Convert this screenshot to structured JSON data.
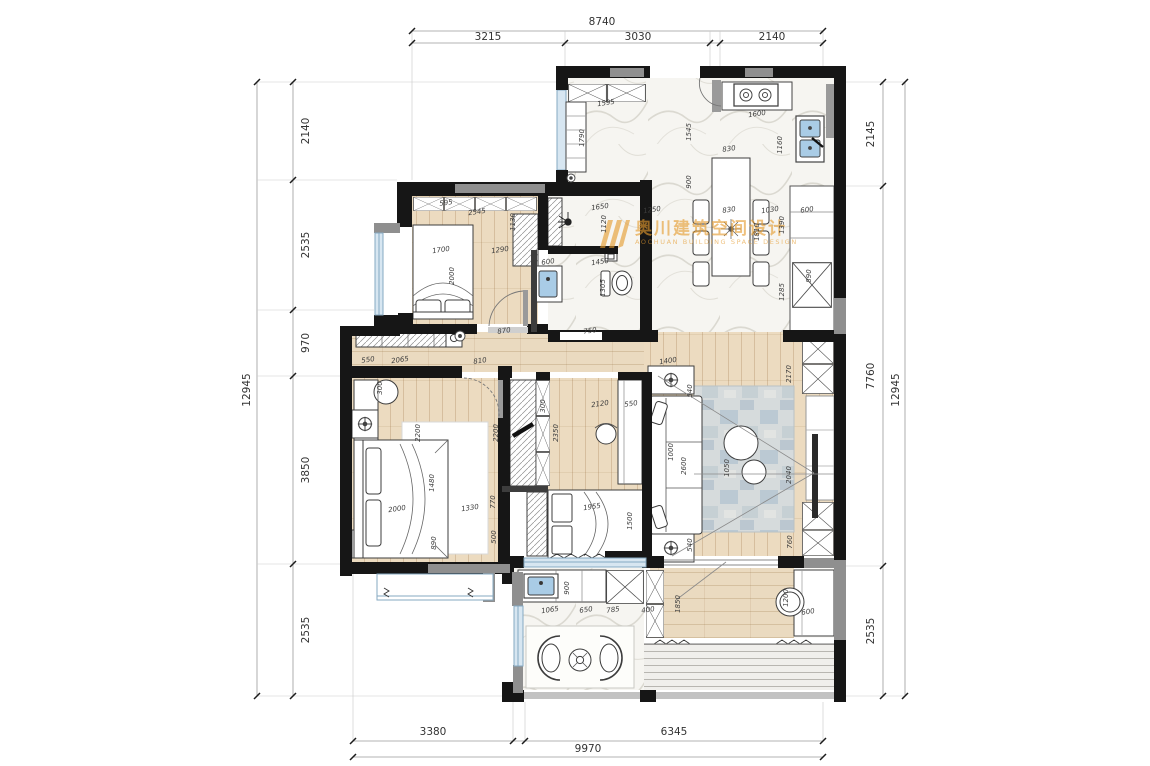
{
  "watermark": {
    "cn": "奥川建筑空间设计",
    "en": "AOCHUAN BUILDING SPACE DESIGN"
  },
  "colors": {
    "wall": "#161616",
    "wall_gray": "#8f8f8f",
    "wood": "#ecdbc0",
    "marble": "#f6f5f1",
    "window": "#d7e6f1",
    "sink": "#a9cce6",
    "watermark": "#e59b2e"
  },
  "dimensions": {
    "top": {
      "overall": "8740",
      "segments": [
        "3215",
        "3030",
        "2140"
      ]
    },
    "bottom": {
      "overall": "9970",
      "segments": [
        "3380",
        "6345"
      ]
    },
    "left": {
      "overall": "12945",
      "segments": [
        "2140",
        "2535",
        "970",
        "3850",
        "2535"
      ]
    },
    "right": {
      "overall": "12945",
      "segments": [
        "2145",
        "7760",
        "2535"
      ]
    }
  },
  "dim_labels": [
    {
      "t": "8740",
      "x": 602,
      "y": 22,
      "r": 0,
      "cls": "lg"
    },
    {
      "t": "3215",
      "x": 488,
      "y": 37,
      "r": 0,
      "cls": "lg"
    },
    {
      "t": "3030",
      "x": 638,
      "y": 37,
      "r": 0,
      "cls": "lg"
    },
    {
      "t": "2140",
      "x": 772,
      "y": 37,
      "r": 0,
      "cls": "lg"
    },
    {
      "t": "12945",
      "x": 247,
      "y": 390,
      "r": -90,
      "cls": "lg"
    },
    {
      "t": "2140",
      "x": 306,
      "y": 131,
      "r": -90,
      "cls": "lg"
    },
    {
      "t": "2535",
      "x": 306,
      "y": 245,
      "r": -90,
      "cls": "lg"
    },
    {
      "t": "970",
      "x": 306,
      "y": 343,
      "r": -90,
      "cls": "lg"
    },
    {
      "t": "3850",
      "x": 306,
      "y": 470,
      "r": -90,
      "cls": "lg"
    },
    {
      "t": "2535",
      "x": 306,
      "y": 630,
      "r": -90,
      "cls": "lg"
    },
    {
      "t": "2145",
      "x": 871,
      "y": 134,
      "r": -90,
      "cls": "lg"
    },
    {
      "t": "7760",
      "x": 871,
      "y": 376,
      "r": -90,
      "cls": "lg"
    },
    {
      "t": "2535",
      "x": 871,
      "y": 631,
      "r": -90,
      "cls": "lg"
    },
    {
      "t": "12945",
      "x": 896,
      "y": 390,
      "r": -90,
      "cls": "lg"
    },
    {
      "t": "3380",
      "x": 433,
      "y": 732,
      "r": 0,
      "cls": "lg"
    },
    {
      "t": "6345",
      "x": 674,
      "y": 732,
      "r": 0,
      "cls": "lg"
    },
    {
      "t": "9970",
      "x": 588,
      "y": 749,
      "r": 0,
      "cls": "lg"
    },
    {
      "t": "1595",
      "x": 606,
      "y": 103,
      "r": -8
    },
    {
      "t": "1790",
      "x": 582,
      "y": 138,
      "r": -90
    },
    {
      "t": "1600",
      "x": 757,
      "y": 114,
      "r": -8
    },
    {
      "t": "1545",
      "x": 689,
      "y": 132,
      "r": -90
    },
    {
      "t": "1160",
      "x": 780,
      "y": 145,
      "r": -90
    },
    {
      "t": "830",
      "x": 729,
      "y": 149,
      "r": -8
    },
    {
      "t": "900",
      "x": 689,
      "y": 182,
      "r": -90
    },
    {
      "t": "1250",
      "x": 652,
      "y": 210,
      "r": -8
    },
    {
      "t": "830",
      "x": 729,
      "y": 210,
      "r": -8
    },
    {
      "t": "1030",
      "x": 770,
      "y": 210,
      "r": -8
    },
    {
      "t": "1810",
      "x": 757,
      "y": 232,
      "r": -90
    },
    {
      "t": "1390",
      "x": 782,
      "y": 225,
      "r": -90
    },
    {
      "t": "1285",
      "x": 782,
      "y": 292,
      "r": -90
    },
    {
      "t": "600",
      "x": 807,
      "y": 210,
      "r": -8
    },
    {
      "t": "890",
      "x": 809,
      "y": 276,
      "r": -90
    },
    {
      "t": "595",
      "x": 446,
      "y": 203,
      "r": -8
    },
    {
      "t": "2545",
      "x": 477,
      "y": 212,
      "r": -8
    },
    {
      "t": "1130",
      "x": 513,
      "y": 222,
      "r": -90
    },
    {
      "t": "1700",
      "x": 441,
      "y": 250,
      "r": -8
    },
    {
      "t": "1290",
      "x": 500,
      "y": 250,
      "r": -8
    },
    {
      "t": "2000",
      "x": 452,
      "y": 276,
      "r": -90
    },
    {
      "t": "870",
      "x": 504,
      "y": 331,
      "r": -8
    },
    {
      "t": "1650",
      "x": 600,
      "y": 207,
      "r": -8
    },
    {
      "t": "1120",
      "x": 604,
      "y": 224,
      "r": -90
    },
    {
      "t": "600",
      "x": 548,
      "y": 262,
      "r": -8
    },
    {
      "t": "1450",
      "x": 600,
      "y": 262,
      "r": -8
    },
    {
      "t": "1305",
      "x": 603,
      "y": 288,
      "r": -90
    },
    {
      "t": "750",
      "x": 590,
      "y": 331,
      "r": -8
    },
    {
      "t": "810",
      "x": 480,
      "y": 361,
      "r": -8
    },
    {
      "t": "1400",
      "x": 668,
      "y": 361,
      "r": -8
    },
    {
      "t": "550",
      "x": 368,
      "y": 360,
      "r": -8
    },
    {
      "t": "2065",
      "x": 400,
      "y": 360,
      "r": -8
    },
    {
      "t": "300",
      "x": 380,
      "y": 388,
      "r": -90
    },
    {
      "t": "2200",
      "x": 418,
      "y": 433,
      "r": -90
    },
    {
      "t": "2200",
      "x": 496,
      "y": 433,
      "r": -90
    },
    {
      "t": "1480",
      "x": 432,
      "y": 483,
      "r": -90
    },
    {
      "t": "2000",
      "x": 397,
      "y": 509,
      "r": -8
    },
    {
      "t": "1330",
      "x": 470,
      "y": 508,
      "r": -8
    },
    {
      "t": "770",
      "x": 493,
      "y": 502,
      "r": -90
    },
    {
      "t": "500",
      "x": 494,
      "y": 537,
      "r": -90
    },
    {
      "t": "890",
      "x": 434,
      "y": 543,
      "r": -90
    },
    {
      "t": "300",
      "x": 543,
      "y": 406,
      "r": -90
    },
    {
      "t": "2350",
      "x": 556,
      "y": 433,
      "r": -90
    },
    {
      "t": "2120",
      "x": 600,
      "y": 404,
      "r": -8
    },
    {
      "t": "550",
      "x": 631,
      "y": 404,
      "r": -8
    },
    {
      "t": "1955",
      "x": 592,
      "y": 507,
      "r": -8
    },
    {
      "t": "1500",
      "x": 630,
      "y": 521,
      "r": -90
    },
    {
      "t": "2170",
      "x": 789,
      "y": 374,
      "r": -90
    },
    {
      "t": "540",
      "x": 690,
      "y": 391,
      "r": -90
    },
    {
      "t": "1000",
      "x": 671,
      "y": 452,
      "r": -90
    },
    {
      "t": "2600",
      "x": 684,
      "y": 466,
      "r": -90
    },
    {
      "t": "1050",
      "x": 727,
      "y": 468,
      "r": -90
    },
    {
      "t": "2040",
      "x": 789,
      "y": 475,
      "r": -90
    },
    {
      "t": "540",
      "x": 690,
      "y": 545,
      "r": -90
    },
    {
      "t": "760",
      "x": 790,
      "y": 542,
      "r": -90
    },
    {
      "t": "1200",
      "x": 786,
      "y": 598,
      "r": -90
    },
    {
      "t": "600",
      "x": 808,
      "y": 612,
      "r": -8
    },
    {
      "t": "1850",
      "x": 678,
      "y": 604,
      "r": -90
    },
    {
      "t": "900",
      "x": 567,
      "y": 588,
      "r": -90
    },
    {
      "t": "1065",
      "x": 550,
      "y": 610,
      "r": -8
    },
    {
      "t": "650",
      "x": 586,
      "y": 610,
      "r": -8
    },
    {
      "t": "785",
      "x": 613,
      "y": 610,
      "r": -8
    },
    {
      "t": "400",
      "x": 648,
      "y": 610,
      "r": -8
    }
  ]
}
